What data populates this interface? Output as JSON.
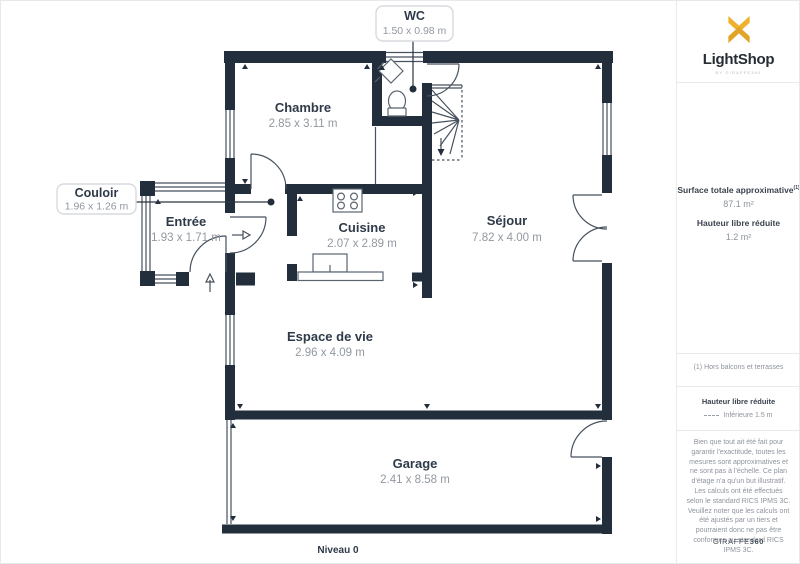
{
  "brand": {
    "name": "LightShop",
    "tagline": "BY GIRAFFE360"
  },
  "panel": {
    "surface_label": "Surface totale approximative",
    "surface_sup": "(1)",
    "surface_value": "87.1 m²",
    "height_label": "Hauteur libre réduite",
    "height_value": "1.2 m²",
    "footnote": "(1) Hors balcons et terrasses",
    "legend_title": "Hauteur libre réduite",
    "legend_item": "Inférieure 1.5 m",
    "disclaimer_1": "Bien que tout ait été fait pour garantir l'exactitude, toutes les mesures sont approximatives et ne sont pas à l'échelle. Ce plan d'étage n'a qu'un but illustratif.",
    "disclaimer_2": "Les calculs ont été effectués selon le standard RICS IPMS 3C. Veuillez noter que les calculs ont été ajustés par un tiers et pourraient donc ne pas être conformes au standard RICS IPMS 3C.",
    "footer_left": "GIRAFFE",
    "footer_right": "360"
  },
  "plan": {
    "level_label": "Niveau 0",
    "rooms": {
      "chambre": {
        "name": "Chambre",
        "dims": "2.85 x 3.11 m"
      },
      "cuisine": {
        "name": "Cuisine",
        "dims": "2.07 x 2.89 m"
      },
      "sejour": {
        "name": "Séjour",
        "dims": "7.82 x 4.00 m"
      },
      "entree": {
        "name": "Entrée",
        "dims": "1.93 x 1.71 m"
      },
      "espace": {
        "name": "Espace de vie",
        "dims": "2.96 x 4.09 m"
      },
      "garage": {
        "name": "Garage",
        "dims": "2.41 x 8.58 m"
      }
    },
    "callouts": {
      "wc": {
        "name": "WC",
        "dims": "1.50 x 0.98 m"
      },
      "couloir": {
        "name": "Couloir",
        "dims": "1.96 x 1.26 m"
      }
    }
  },
  "colors": {
    "wall": "#222e3c",
    "accent": "#efb12f",
    "accent_dark": "#e2a326",
    "room_text": "#2e3a48",
    "dim_text": "#9298a0"
  }
}
